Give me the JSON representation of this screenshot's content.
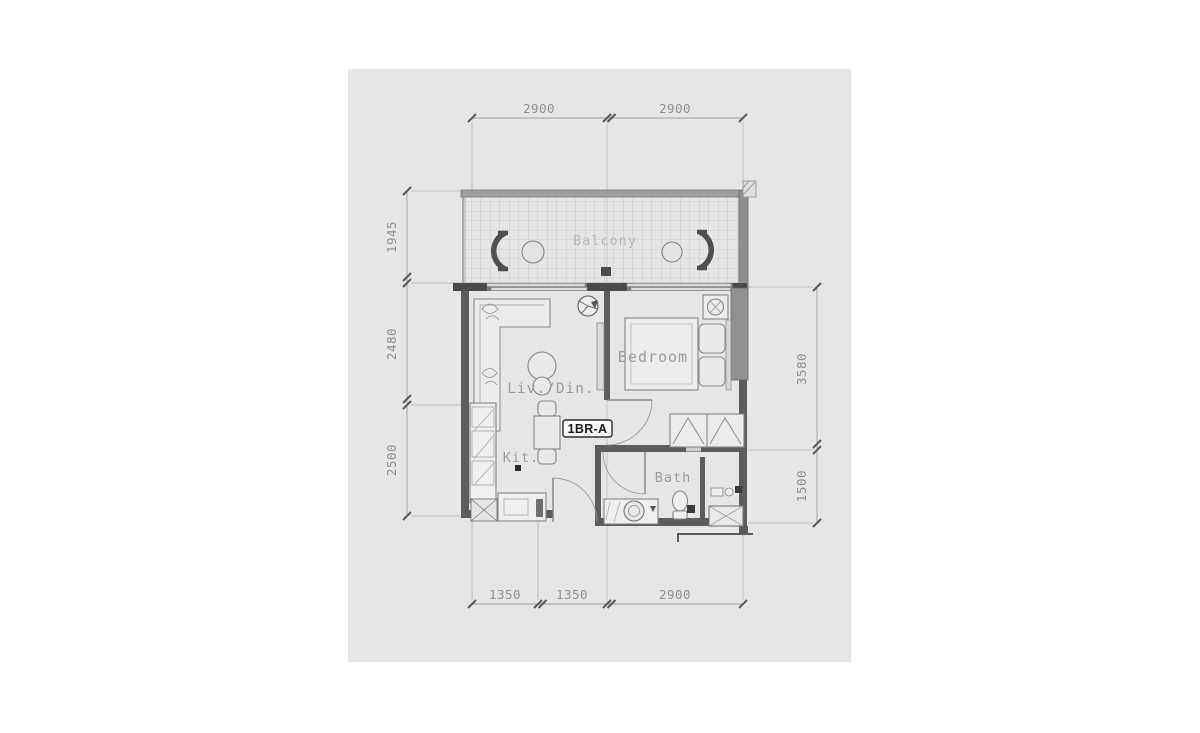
{
  "panel": {
    "bg": "#e6e6e6"
  },
  "unit": {
    "label": "1BR-A"
  },
  "rooms": {
    "balcony": "Balcony",
    "bedroom": "Bedroom",
    "living_dining": "Liv./Din.",
    "kitchen": "Kit.",
    "bath": "Bath"
  },
  "dimensions": {
    "top": [
      "2900",
      "2900"
    ],
    "bottom": [
      "1350",
      "1350",
      "2900"
    ],
    "left": [
      "1945",
      "2480",
      "2500"
    ],
    "right": [
      "3580",
      "1500"
    ]
  },
  "colors": {
    "dimension": "#8f8f8f",
    "room_label": "#9c9c9c",
    "balcony_label": "#b6b6b6",
    "wall": "#5c5c5c",
    "wall_fill": "#9a9a9a",
    "furniture": "#8a8a8a",
    "unit_label_text": "#1b1b1b"
  }
}
